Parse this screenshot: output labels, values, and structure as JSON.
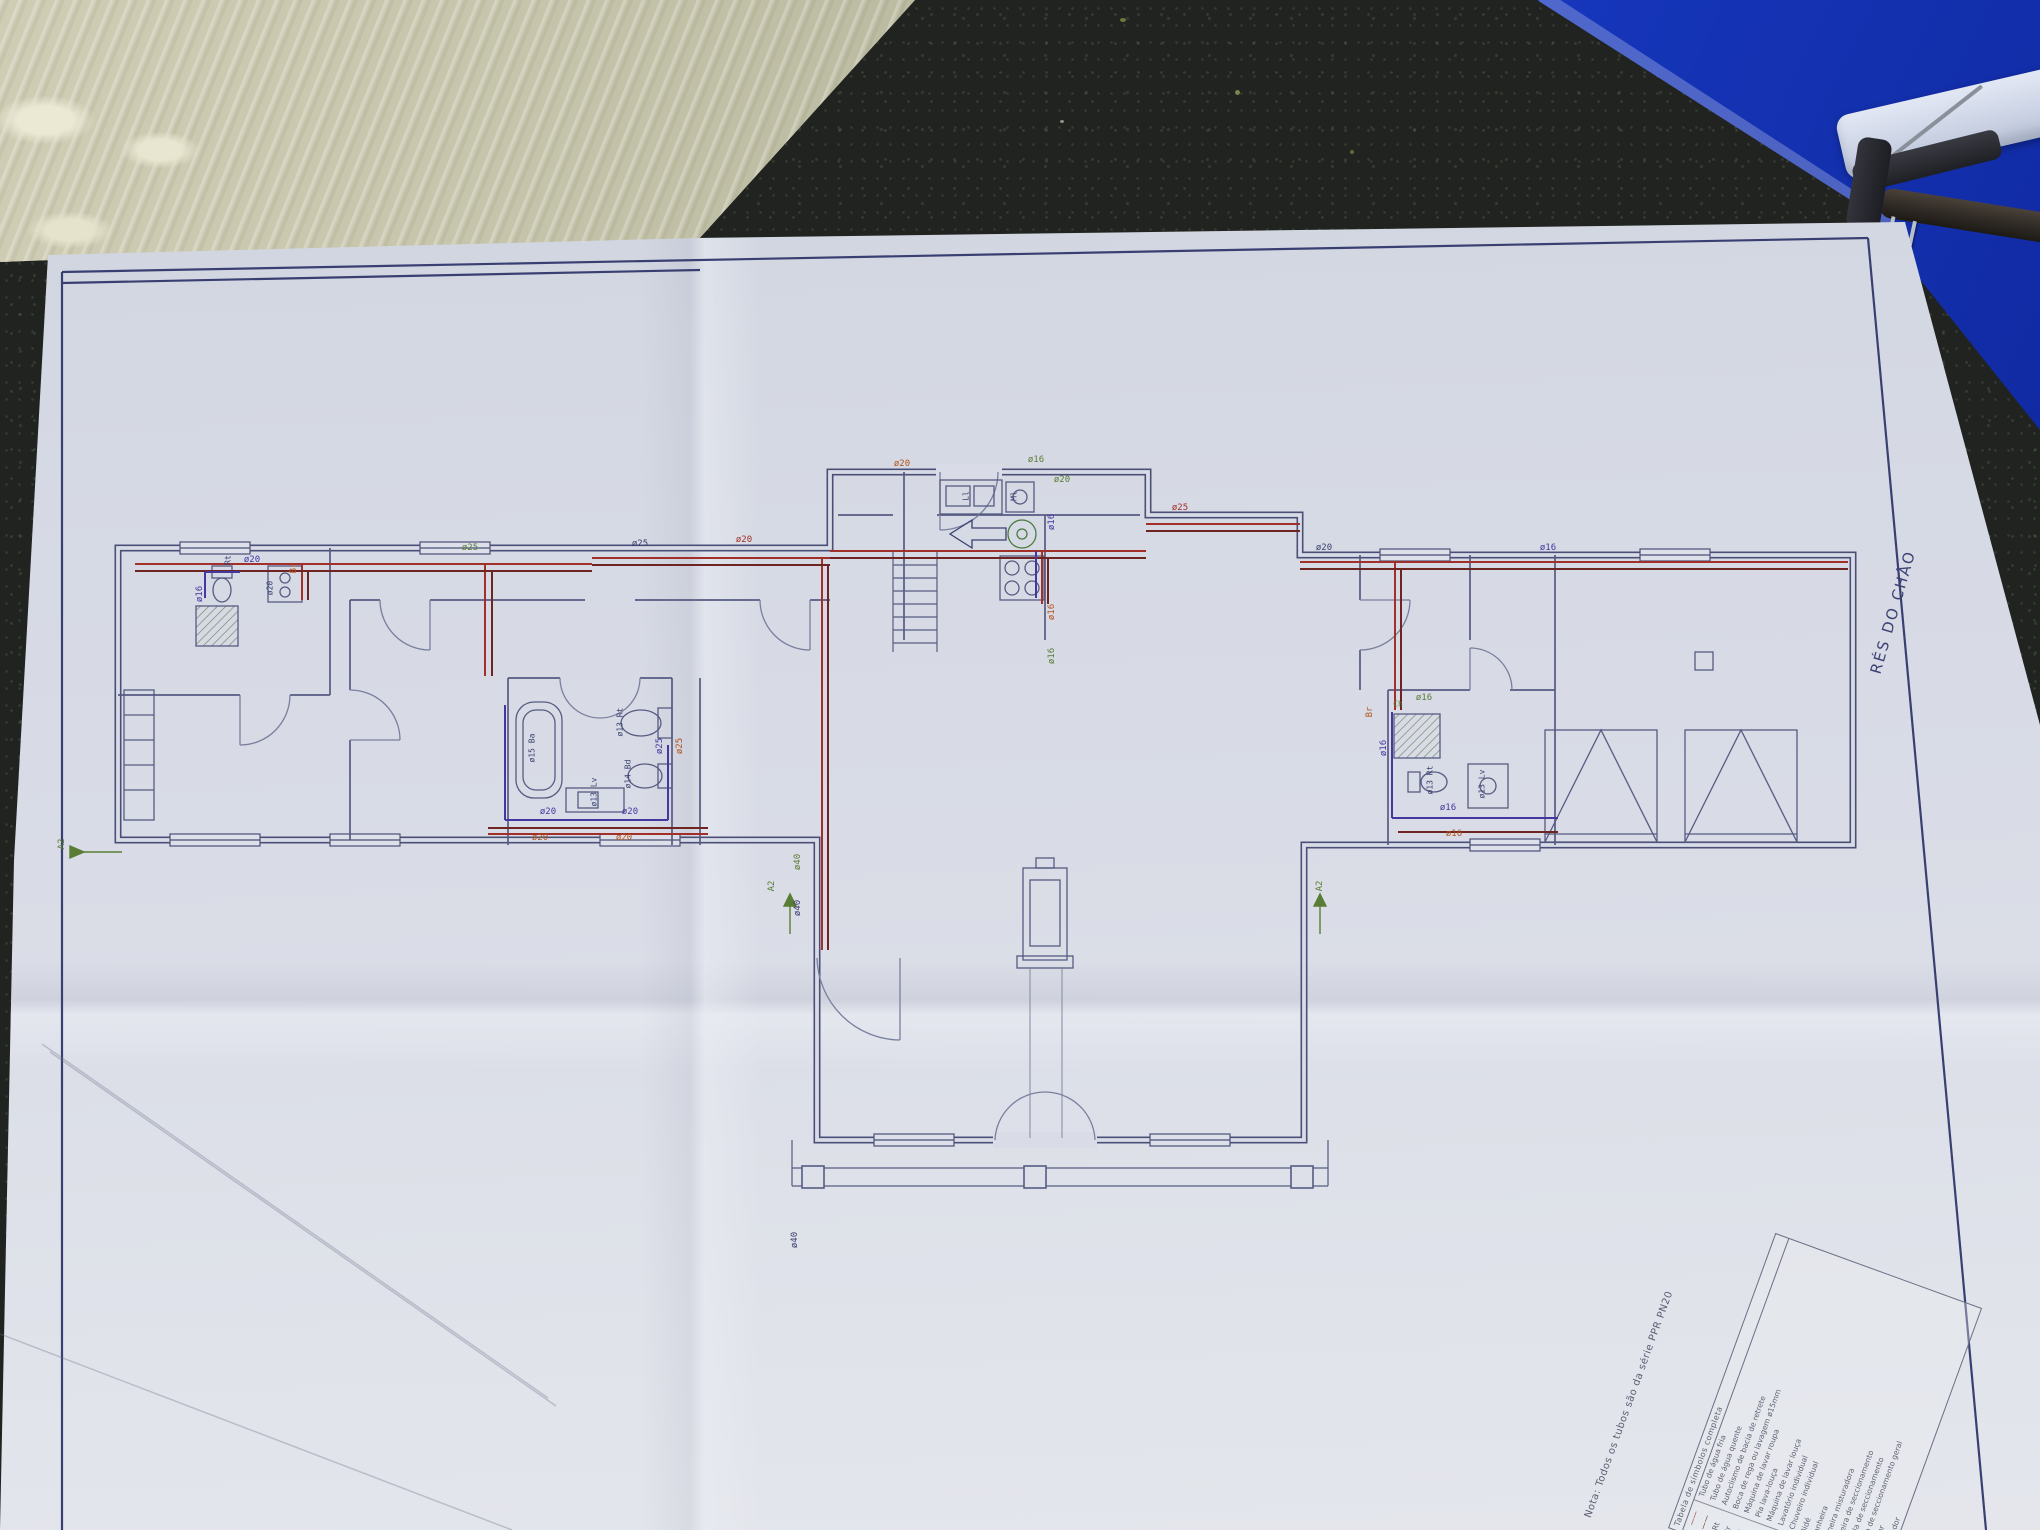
{
  "photo": {
    "countertop": {
      "description_colors": {
        "base": "#20231f",
        "speckle": "#8a9480"
      }
    },
    "plan": {
      "floor_title": "RÉS DO CHÃO",
      "note": "Nota: Todos os tubos são da série PPR PN20",
      "colors": {
        "cold_water_pipe": "#a33028",
        "hot_water_pipe": "#6e2420",
        "fitting": "#4636a0",
        "annotation_green": "#5a7d35",
        "annotation_orange": "#b3541e",
        "wall_ink": "#4a4f78",
        "paper": "#d9dce6",
        "folder_blue": "#1b3ed6"
      },
      "legend": {
        "header": "Tabela de símbolos completa",
        "rows": [
          {
            "symbol": "——",
            "symc": "#a33028",
            "desc": "Tubo de água fria"
          },
          {
            "symbol": "——",
            "symc": "#6e2420",
            "desc": "Tubo de água quente"
          },
          {
            "symbol": "Rt",
            "desc": "Autoclismo de bacia de retrete"
          },
          {
            "symbol": "Br",
            "desc": "Boca de rega ou lavagem ø15mm"
          },
          {
            "symbol": "Mr",
            "desc": "Máquina de lavar roupa"
          },
          {
            "symbol": "Ll",
            "desc": "Pia lava-louça"
          },
          {
            "symbol": "Ml",
            "desc": "Máquina de lavar louça"
          },
          {
            "symbol": "Lv",
            "desc": "Lavatório individual"
          },
          {
            "symbol": "Ch",
            "desc": "Chuveiro individual"
          },
          {
            "symbol": "Bd",
            "desc": "Bidé"
          },
          {
            "symbol": "Ba",
            "desc": "Banheira"
          },
          {
            "symbol": "T",
            "desc": "Torneira misturadora"
          },
          {
            "symbol": "Tt",
            "desc": "Torneira de seccionamento"
          },
          {
            "symbol": "⊠",
            "desc": "Válvula de seccionamento"
          },
          {
            "symbol": "◆",
            "desc": "Válvula de seccionamento geral"
          },
          {
            "symbol": "●",
            "desc": "Contador"
          },
          {
            "symbol": "◎",
            "desc": "Esquentador"
          }
        ]
      },
      "pipe_labels": [
        {
          "t": "ø16",
          "x": 200,
          "y": 594,
          "rot": -90,
          "c": "#4636a0",
          "fs": 9
        },
        {
          "t": "ø20",
          "x": 252,
          "y": 560,
          "rot": 0,
          "c": "#4636a0",
          "fs": 9
        },
        {
          "t": "Br",
          "x": 294,
          "y": 568,
          "rot": -90,
          "c": "#b3541e",
          "fs": 9
        },
        {
          "t": "ø20",
          "x": 270,
          "y": 588,
          "rot": -90,
          "c": "#3a4070",
          "fs": 8
        },
        {
          "t": "Rt",
          "x": 228,
          "y": 560,
          "rot": -90,
          "c": "#3a4070",
          "fs": 8
        },
        {
          "t": "ø25",
          "x": 470,
          "y": 548,
          "rot": 0,
          "c": "#5a7d35",
          "fs": 9
        },
        {
          "t": "ø25",
          "x": 640,
          "y": 544,
          "rot": 0,
          "c": "#3a4070",
          "fs": 9
        },
        {
          "t": "ø20",
          "x": 744,
          "y": 540,
          "rot": 0,
          "c": "#a33028",
          "fs": 9
        },
        {
          "t": "ø20",
          "x": 902,
          "y": 464,
          "rot": 0,
          "c": "#b3541e",
          "fs": 9
        },
        {
          "t": "ø16",
          "x": 1036,
          "y": 460,
          "rot": 0,
          "c": "#5a7d35",
          "fs": 9
        },
        {
          "t": "ø20",
          "x": 1062,
          "y": 480,
          "rot": 0,
          "c": "#5a7d35",
          "fs": 9
        },
        {
          "t": "ø25",
          "x": 1180,
          "y": 508,
          "rot": 0,
          "c": "#a33028",
          "fs": 9
        },
        {
          "t": "ø20",
          "x": 1324,
          "y": 548,
          "rot": 0,
          "c": "#3a4070",
          "fs": 9
        },
        {
          "t": "ø16",
          "x": 1548,
          "y": 548,
          "rot": 0,
          "c": "#4636a0",
          "fs": 9
        },
        {
          "t": "ø16",
          "x": 1052,
          "y": 522,
          "rot": -90,
          "c": "#4636a0",
          "fs": 9
        },
        {
          "t": "ø16",
          "x": 1052,
          "y": 612,
          "rot": -90,
          "c": "#b3541e",
          "fs": 9
        },
        {
          "t": "ø16",
          "x": 1052,
          "y": 656,
          "rot": -90,
          "c": "#5a7d35",
          "fs": 9
        },
        {
          "t": "Ml",
          "x": 1014,
          "y": 496,
          "rot": -90,
          "c": "#3a4070",
          "fs": 8
        },
        {
          "t": "Ll",
          "x": 966,
          "y": 496,
          "rot": -90,
          "c": "#3a4070",
          "fs": 8
        },
        {
          "t": "ø15 Ba",
          "x": 532,
          "y": 748,
          "rot": -90,
          "c": "#3a4070",
          "fs": 8
        },
        {
          "t": "ø13 Rt",
          "x": 620,
          "y": 722,
          "rot": -90,
          "c": "#3a4070",
          "fs": 8
        },
        {
          "t": "ø14 Bd",
          "x": 628,
          "y": 774,
          "rot": -90,
          "c": "#3a4070",
          "fs": 8
        },
        {
          "t": "ø13 Lv",
          "x": 594,
          "y": 792,
          "rot": -90,
          "c": "#3a4070",
          "fs": 8
        },
        {
          "t": "ø20",
          "x": 548,
          "y": 812,
          "rot": 0,
          "c": "#4636a0",
          "fs": 9
        },
        {
          "t": "ø20",
          "x": 540,
          "y": 838,
          "rot": 0,
          "c": "#b3541e",
          "fs": 9
        },
        {
          "t": "ø20",
          "x": 630,
          "y": 812,
          "rot": 0,
          "c": "#4636a0",
          "fs": 9
        },
        {
          "t": "ø20",
          "x": 624,
          "y": 838,
          "rot": 0,
          "c": "#b3541e",
          "fs": 9
        },
        {
          "t": "ø25",
          "x": 660,
          "y": 746,
          "rot": -90,
          "c": "#4636a0",
          "fs": 9
        },
        {
          "t": "ø25",
          "x": 680,
          "y": 746,
          "rot": -90,
          "c": "#b3541e",
          "fs": 9
        },
        {
          "t": "ø16",
          "x": 1424,
          "y": 698,
          "rot": 0,
          "c": "#5a7d35",
          "fs": 9
        },
        {
          "t": "Ch",
          "x": 1398,
          "y": 704,
          "rot": 0,
          "c": "#5a7d35",
          "fs": 8
        },
        {
          "t": "ø16",
          "x": 1384,
          "y": 748,
          "rot": -90,
          "c": "#4636a0",
          "fs": 9
        },
        {
          "t": "Br",
          "x": 1370,
          "y": 712,
          "rot": -90,
          "c": "#b3541e",
          "fs": 9
        },
        {
          "t": "ø13 Rt",
          "x": 1430,
          "y": 780,
          "rot": -90,
          "c": "#3a4070",
          "fs": 8
        },
        {
          "t": "ø13 Lv",
          "x": 1482,
          "y": 784,
          "rot": -90,
          "c": "#3a4070",
          "fs": 8
        },
        {
          "t": "ø16",
          "x": 1448,
          "y": 808,
          "rot": 0,
          "c": "#4636a0",
          "fs": 9
        },
        {
          "t": "ø16",
          "x": 1454,
          "y": 834,
          "rot": 0,
          "c": "#b3541e",
          "fs": 9
        },
        {
          "t": "ø40",
          "x": 798,
          "y": 862,
          "rot": -90,
          "c": "#5a7d35",
          "fs": 9
        },
        {
          "t": "ø40",
          "x": 798,
          "y": 908,
          "rot": -90,
          "c": "#3a4070",
          "fs": 9
        },
        {
          "t": "ø40",
          "x": 795,
          "y": 1240,
          "rot": -90,
          "c": "#3a4070",
          "fs": 9
        },
        {
          "t": "A2",
          "x": 62,
          "y": 844,
          "rot": -90,
          "c": "#5a7d35",
          "fs": 9
        },
        {
          "t": "A2",
          "x": 772,
          "y": 886,
          "rot": -90,
          "c": "#5a7d35",
          "fs": 9
        },
        {
          "t": "A2",
          "x": 1320,
          "y": 886,
          "rot": -90,
          "c": "#5a7d35",
          "fs": 9
        }
      ]
    }
  }
}
